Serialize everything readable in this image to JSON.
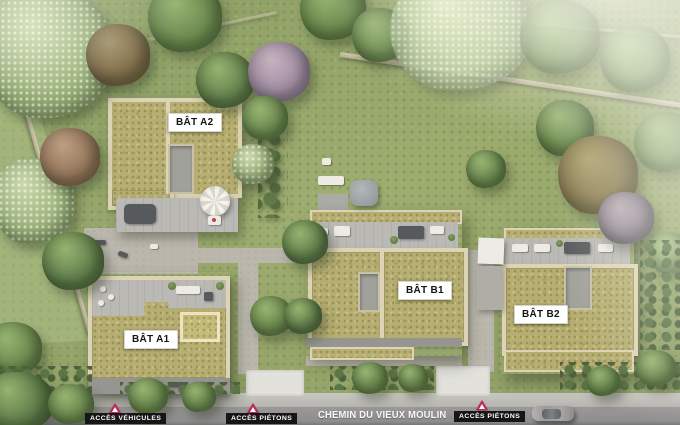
{
  "buildings": [
    {
      "id": "a2",
      "label": "BÂT A2"
    },
    {
      "id": "a1",
      "label": "BÂT A1"
    },
    {
      "id": "b1",
      "label": "BÂT B1"
    },
    {
      "id": "b2",
      "label": "BÂT B2"
    }
  ],
  "road": {
    "name": "CHEMIN DU VIEUX MOULIN"
  },
  "access": [
    {
      "id": "vehicles",
      "label": "ACCÈS VÉHICULES"
    },
    {
      "id": "pedestrians-1",
      "label": "ACCÈS PIÉTONS"
    },
    {
      "id": "pedestrians-2",
      "label": "ACCÈS PIÉTONS"
    }
  ],
  "icons": {
    "access_marker": "triangle-up",
    "car": "car-top-view"
  },
  "colors": {
    "lawn": "#85965b",
    "sedum_roof": "#b1a96a",
    "parapet": "#dbd1b2",
    "terrace": "#b6b5b1",
    "road": "#8c8b89",
    "sidewalk": "#b8b6b2",
    "building_label_bg": "#ffffff",
    "building_label_text": "#141414",
    "access_label_bg": "#161616",
    "access_label_text": "#ffffff",
    "access_marker": "#c2245a"
  }
}
